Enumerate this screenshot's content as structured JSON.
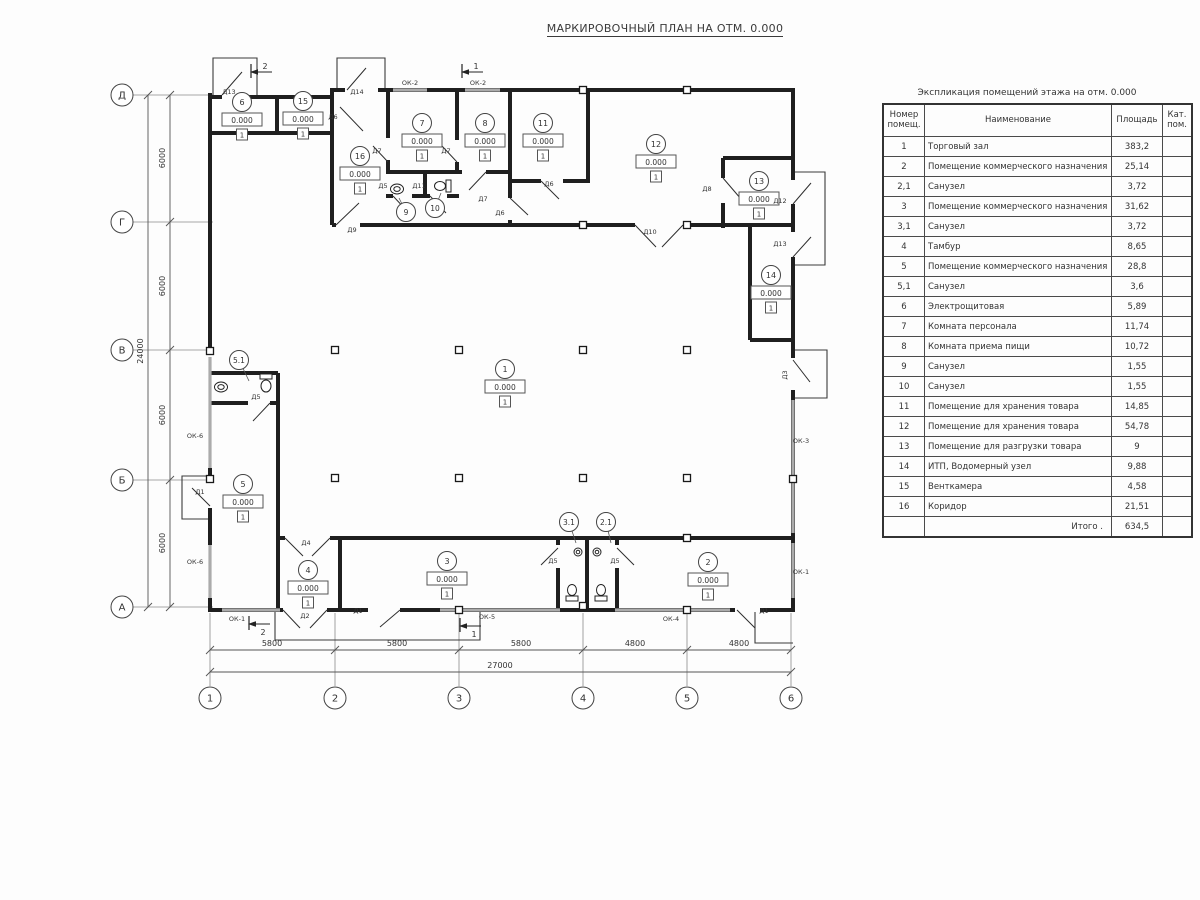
{
  "title": "МАРКИРОВОЧНЫЙ ПЛАН НА ОТМ. 0.000",
  "plan": {
    "elevation": "0.000",
    "floor_mark": "1",
    "axes_cols": [
      {
        "label": "1",
        "x": 210
      },
      {
        "label": "2",
        "x": 335
      },
      {
        "label": "3",
        "x": 459
      },
      {
        "label": "4",
        "x": 583
      },
      {
        "label": "5",
        "x": 687
      },
      {
        "label": "6",
        "x": 791
      }
    ],
    "axes_rows": [
      {
        "label": "Д",
        "y": 95
      },
      {
        "label": "Г",
        "y": 222
      },
      {
        "label": "В",
        "y": 350
      },
      {
        "label": "Б",
        "y": 480
      },
      {
        "label": "А",
        "y": 607
      }
    ],
    "dims_bottom": [
      {
        "t": "5800",
        "x": 272
      },
      {
        "t": "5800",
        "x": 397
      },
      {
        "t": "5800",
        "x": 521
      },
      {
        "t": "4800",
        "x": 635
      },
      {
        "t": "4800",
        "x": 739
      }
    ],
    "dim_bottom_total": {
      "t": "27000",
      "x": 500
    },
    "dims_left": [
      {
        "t": "6000",
        "y": 158
      },
      {
        "t": "6000",
        "y": 286
      },
      {
        "t": "6000",
        "y": 415
      },
      {
        "t": "6000",
        "y": 543
      }
    ],
    "dim_left_total": {
      "t": "24000",
      "y": 351
    },
    "rooms_full": [
      {
        "num": "1",
        "x": 505,
        "y": 369
      },
      {
        "num": "2",
        "x": 708,
        "y": 562
      },
      {
        "num": "3",
        "x": 447,
        "y": 561
      },
      {
        "num": "4",
        "x": 308,
        "y": 570
      },
      {
        "num": "5",
        "x": 243,
        "y": 484
      },
      {
        "num": "6",
        "x": 242,
        "y": 102
      },
      {
        "num": "7",
        "x": 422,
        "y": 123
      },
      {
        "num": "8",
        "x": 485,
        "y": 123
      },
      {
        "num": "11",
        "x": 543,
        "y": 123
      },
      {
        "num": "12",
        "x": 656,
        "y": 144
      },
      {
        "num": "13",
        "x": 759,
        "y": 181
      },
      {
        "num": "14",
        "x": 771,
        "y": 275
      },
      {
        "num": "15",
        "x": 303,
        "y": 101
      },
      {
        "num": "16",
        "x": 360,
        "y": 156
      }
    ],
    "rooms_circle": [
      {
        "num": "5.1",
        "x": 239,
        "y": 360,
        "lx": 249,
        "ly": 381
      },
      {
        "num": "9",
        "x": 406,
        "y": 212,
        "lx": 399,
        "ly": 198
      },
      {
        "num": "10",
        "x": 435,
        "y": 208,
        "lx": 441,
        "ly": 193
      },
      {
        "num": "3.1",
        "x": 569,
        "y": 522,
        "lx": 576,
        "ly": 543
      },
      {
        "num": "2.1",
        "x": 606,
        "y": 522,
        "lx": 611,
        "ly": 543
      }
    ],
    "door_labels": [
      {
        "t": "Д13",
        "x": 229,
        "y": 94
      },
      {
        "t": "Д14",
        "x": 357,
        "y": 94
      },
      {
        "t": "Д6",
        "x": 333,
        "y": 119
      },
      {
        "t": "Д9",
        "x": 352,
        "y": 232
      },
      {
        "t": "Д7",
        "x": 377,
        "y": 153
      },
      {
        "t": "Д7",
        "x": 446,
        "y": 153
      },
      {
        "t": "Д7",
        "x": 483,
        "y": 201
      },
      {
        "t": "Д5",
        "x": 383,
        "y": 188
      },
      {
        "t": "Д11",
        "x": 419,
        "y": 188
      },
      {
        "t": "Д6",
        "x": 500,
        "y": 215
      },
      {
        "t": "Д6",
        "x": 549,
        "y": 186
      },
      {
        "t": "Д10",
        "x": 650,
        "y": 234
      },
      {
        "t": "Д8",
        "x": 707,
        "y": 191
      },
      {
        "t": "Д12",
        "x": 780,
        "y": 203
      },
      {
        "t": "Д13",
        "x": 780,
        "y": 246
      },
      {
        "t": "Д3",
        "x": 787,
        "y": 375,
        "rot": -90
      },
      {
        "t": "Д5",
        "x": 256,
        "y": 399
      },
      {
        "t": "Д1",
        "x": 200,
        "y": 494
      },
      {
        "t": "Д4",
        "x": 306,
        "y": 545
      },
      {
        "t": "Д2",
        "x": 305,
        "y": 618
      },
      {
        "t": "Д1",
        "x": 358,
        "y": 613
      },
      {
        "t": "Д5",
        "x": 553,
        "y": 563
      },
      {
        "t": "Д5",
        "x": 615,
        "y": 563
      },
      {
        "t": "Д1",
        "x": 764,
        "y": 613
      }
    ],
    "window_labels": [
      {
        "t": "ОК-2",
        "x": 410,
        "y": 85
      },
      {
        "t": "ОК-2",
        "x": 478,
        "y": 85
      },
      {
        "t": "ОК-6",
        "x": 195,
        "y": 438
      },
      {
        "t": "ОК-6",
        "x": 195,
        "y": 564
      },
      {
        "t": "ОК-3",
        "x": 801,
        "y": 443
      },
      {
        "t": "ОК-1",
        "x": 801,
        "y": 574
      },
      {
        "t": "ОК-1",
        "x": 237,
        "y": 621
      },
      {
        "t": "ОК-5",
        "x": 487,
        "y": 619
      },
      {
        "t": "ОК-4",
        "x": 671,
        "y": 621
      }
    ],
    "section_marks": [
      {
        "num": "2",
        "x": 250,
        "y": 72,
        "dy": -3
      },
      {
        "num": "1",
        "x": 461,
        "y": 72,
        "dy": -3
      },
      {
        "num": "2",
        "x": 248,
        "y": 624,
        "dy": 11
      },
      {
        "num": "1",
        "x": 459,
        "y": 626,
        "dy": 11
      }
    ]
  },
  "table": {
    "title": "Экспликация помещений этажа на отм. 0.000",
    "headers": {
      "num": "Номер\nпомещ.",
      "name": "Наименование",
      "area": "Площадь",
      "cat": "Кат.\nпом."
    },
    "rows": [
      {
        "num": "1",
        "name": "Торговый зал",
        "area": "383,2",
        "cat": ""
      },
      {
        "num": "2",
        "name": "Помещение коммерческого назначения",
        "area": "25,14",
        "cat": ""
      },
      {
        "num": "2,1",
        "name": "Санузел",
        "area": "3,72",
        "cat": ""
      },
      {
        "num": "3",
        "name": "Помещение коммерческого назначения",
        "area": "31,62",
        "cat": ""
      },
      {
        "num": "3,1",
        "name": "Санузел",
        "area": "3,72",
        "cat": ""
      },
      {
        "num": "4",
        "name": "Тамбур",
        "area": "8,65",
        "cat": ""
      },
      {
        "num": "5",
        "name": "Помещение коммерческого назначения",
        "area": "28,8",
        "cat": ""
      },
      {
        "num": "5,1",
        "name": "Санузел",
        "area": "3,6",
        "cat": ""
      },
      {
        "num": "6",
        "name": "Электрощитовая",
        "area": "5,89",
        "cat": ""
      },
      {
        "num": "7",
        "name": "Комната персонала",
        "area": "11,74",
        "cat": ""
      },
      {
        "num": "8",
        "name": "Комната приема пищи",
        "area": "10,72",
        "cat": ""
      },
      {
        "num": "9",
        "name": "Санузел",
        "area": "1,55",
        "cat": ""
      },
      {
        "num": "10",
        "name": "Санузел",
        "area": "1,55",
        "cat": ""
      },
      {
        "num": "11",
        "name": "Помещение для хранения товара",
        "area": "14,85",
        "cat": ""
      },
      {
        "num": "12",
        "name": "Помещение для хранения товара",
        "area": "54,78",
        "cat": ""
      },
      {
        "num": "13",
        "name": "Помещение для разгрузки товара",
        "area": "9",
        "cat": ""
      },
      {
        "num": "14",
        "name": "ИТП, Водомерный узел",
        "area": "9,88",
        "cat": ""
      },
      {
        "num": "15",
        "name": "Венткамера",
        "area": "4,58",
        "cat": ""
      },
      {
        "num": "16",
        "name": "Коридор",
        "area": "21,51",
        "cat": ""
      }
    ],
    "total_label": "Итого .",
    "total_value": "634,5"
  }
}
